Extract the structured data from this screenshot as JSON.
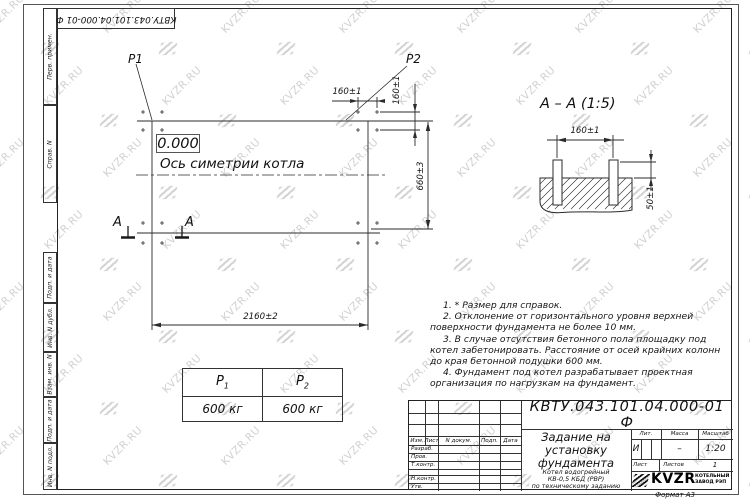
{
  "watermark": {
    "text": "KVZR.RU"
  },
  "colors": {
    "line": "#2b2b2b",
    "text": "#111111",
    "watermark": "#b5b5b5"
  },
  "stamp_rotated": {
    "text": "КВТУ.043.101.04.000-01 Ф"
  },
  "side_strip": {
    "labels": [
      "Перв. примен.",
      "Справ. N",
      "Подп. и дата",
      "Инв. N дубл.",
      "Взам. инв. N",
      "Подп. и дата",
      "Инв. N подл."
    ]
  },
  "plan": {
    "p1_label": "P1",
    "p2_label": "P2",
    "level_mark": "0.000",
    "axis_label": "Ось симетрии котла",
    "dim_bolt_spacing_h": "160±1",
    "dim_bolt_spacing_v": "160±1",
    "dim_height": "660±3",
    "dim_width": "2160±2",
    "section_letters": [
      "А",
      "А"
    ]
  },
  "section_view": {
    "title": "А – А (1:5)",
    "dim_spacing": "160±1",
    "dim_protrusion": "50±1"
  },
  "notes": [
    "1. * Размер для справок.",
    "2. Отклонение от горизонтального уровня верхней поверхности фундамента не более 10 мм.",
    "3. В случае отсутствия бетонного пола площадку под котел забетонировать. Расстояние от осей крайних колонн до края бетонной подушки 600 мм.",
    "4. Фундамент под котел разрабатывает проектная организация по нагрузкам на фундамент."
  ],
  "load_table": {
    "headers": [
      {
        "base": "P",
        "sub": "1"
      },
      {
        "base": "P",
        "sub": "2"
      }
    ],
    "values": [
      "600 кг",
      "600 кг"
    ]
  },
  "title_block": {
    "doc_number": "КВТУ.043.101.04.000-01 Ф",
    "title_lines": [
      "Задание на",
      "установку",
      "фундамента"
    ],
    "subtitle_lines": [
      "Котел водогрейный",
      "КВ-0,5 КБД (РВР)",
      "по техническому заданию"
    ],
    "header_cols": [
      "Изм.",
      "Лист",
      "N докум.",
      "Подп.",
      "Дата"
    ],
    "signature_rows": [
      "Разраб.",
      "Пров.",
      "Т.контр.",
      "",
      "Н.контр.",
      "Утв."
    ],
    "lit_header": "Лит.",
    "lit_value": "И",
    "massa_header": "Масса",
    "massa_value": "–",
    "masshtab_header": "Масштаб",
    "masshtab_value": "1:20",
    "list_label": "Лист",
    "listov_label": "Листов",
    "listov_value": "1",
    "logo": {
      "wordmark": "KVZR",
      "caption_lines": [
        "КОТЕЛЬНЫЙ",
        "ЗАВОД РЭП"
      ]
    },
    "format_label": "Формат А3"
  }
}
